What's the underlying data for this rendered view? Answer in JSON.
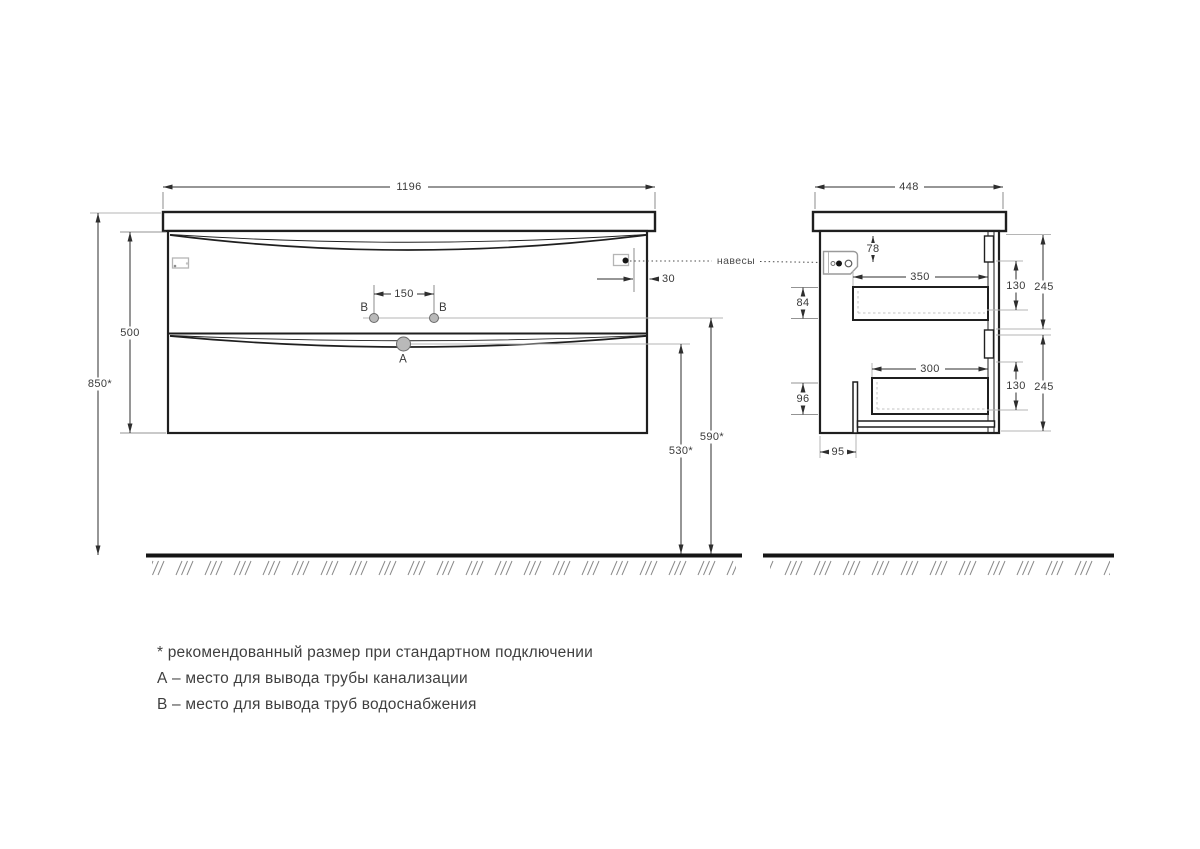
{
  "front": {
    "width": "1196",
    "overall_height": "850*",
    "cabinet_height": "500",
    "water_spacing": "150",
    "hanger_inset": "30",
    "b_height": "590*",
    "a_height": "530*",
    "point_a": "A",
    "point_b_left": "B",
    "point_b_right": "B"
  },
  "side": {
    "depth": "448",
    "hanger_drop": "78",
    "drawer_top_depth": "350",
    "drawer_top_opening": "130",
    "drawer_top_height": "245",
    "drawer_top_back": "84",
    "drawer_bottom_depth": "300",
    "drawer_bottom_opening": "130",
    "drawer_bottom_height": "245",
    "drawer_bottom_back": "96",
    "siphon_offset": "95"
  },
  "callouts": {
    "hangers": "навесы"
  },
  "notes": {
    "asterisk": "* рекомендованный размер при стандартном подключении",
    "a": "А – место для вывода трубы канализации",
    "b": "В – место для вывода труб водоснабжения"
  },
  "colors": {
    "line": "#1f1f1f",
    "dimension": "#2e2e2e",
    "leader": "#b5b5b5",
    "hole_fill": "#b9b9b9",
    "text": "#3a3a3a",
    "floor": "#151515"
  }
}
